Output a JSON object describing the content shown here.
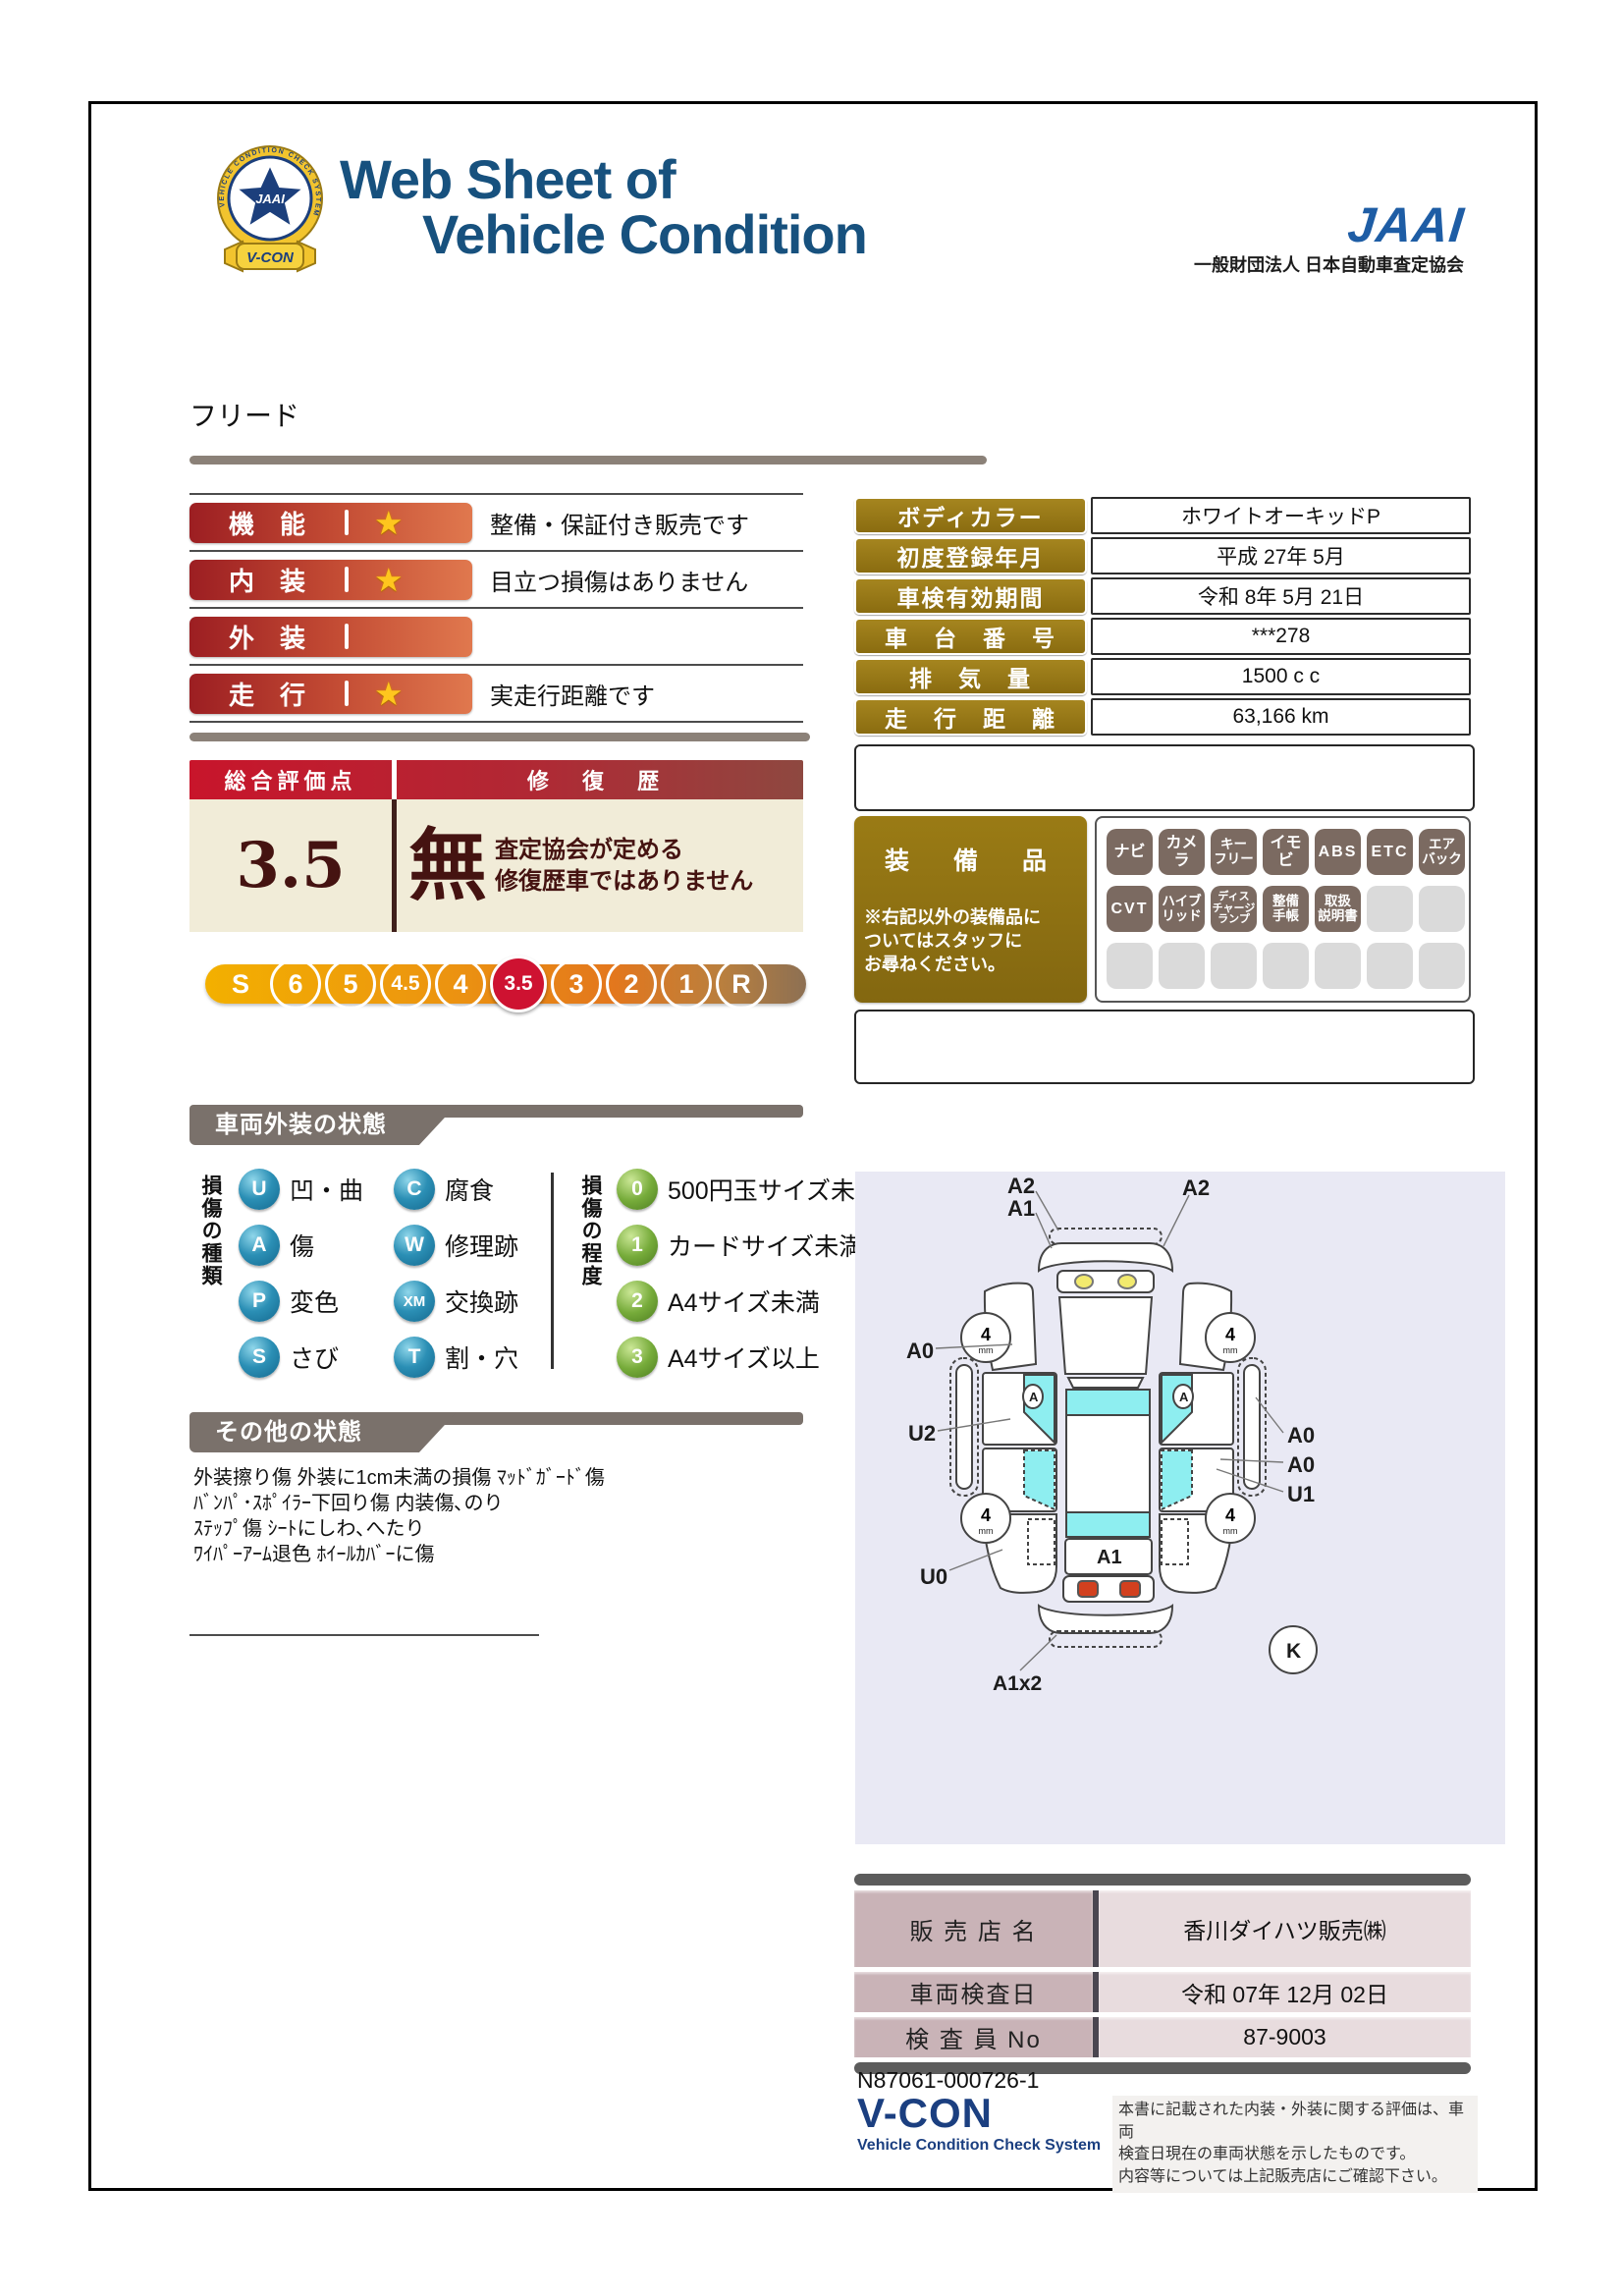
{
  "header": {
    "title_line1": "Web Sheet of",
    "title_line2": "Vehicle Condition",
    "emblem": {
      "ring_text": "VEHICLE CONDITION CHECK SYSTEM",
      "center": "JAAI",
      "ribbon": "V-CON"
    },
    "jaai": {
      "logo": "JAAI",
      "org": "一般財団法人 日本自動車査定協会"
    }
  },
  "vehicle_name": "フリード",
  "ratings": {
    "rows": [
      {
        "label": "機　能",
        "star": true,
        "comment": "整備・保証付き販売です"
      },
      {
        "label": "内　装",
        "star": true,
        "comment": "目立つ損傷はありません"
      },
      {
        "label": "外　装",
        "star": false,
        "comment": ""
      },
      {
        "label": "走　行",
        "star": true,
        "comment": "実走行距離です"
      }
    ]
  },
  "overall": {
    "header_left": "総合評価点",
    "header_right": "修 復 歴",
    "score": "3.5",
    "repair_mark": "無",
    "repair_note": "査定協会が定める\n修復歴車ではありません",
    "scale": [
      {
        "v": "S",
        "ring": false
      },
      {
        "v": "6"
      },
      {
        "v": "5"
      },
      {
        "v": "4.5"
      },
      {
        "v": "4"
      },
      {
        "v": "3.5",
        "active": true
      },
      {
        "v": "3"
      },
      {
        "v": "2"
      },
      {
        "v": "1"
      },
      {
        "v": "R"
      }
    ]
  },
  "info_table": {
    "rows": [
      {
        "label": "ボディカラー",
        "value": "ホワイトオーキッドP"
      },
      {
        "label": "初度登録年月",
        "value": "平成 27年 5月"
      },
      {
        "label": "車検有効期間",
        "value": "令和 8年 5月 21日"
      },
      {
        "label": "車　台　番　号",
        "value": "***278"
      },
      {
        "label": "排　気　量",
        "value": "1500 c c"
      },
      {
        "label": "走　行　距　離",
        "value": "63,166 km"
      }
    ]
  },
  "equipment": {
    "title": "装　備　品",
    "note": "※右記以外の装備品に\nついてはスタッフに\nお尋ねください。",
    "badges": [
      {
        "label": "ナビ",
        "active": true
      },
      {
        "label": "カメラ",
        "active": true
      },
      {
        "label": "キー\nフリー",
        "active": true
      },
      {
        "label": "イモビ",
        "active": true
      },
      {
        "label": "ABS",
        "active": true
      },
      {
        "label": "ETC",
        "active": true
      },
      {
        "label": "エア\nバック",
        "active": true
      },
      {
        "label": "CVT",
        "active": true
      },
      {
        "label": "ハイブ\nリッド",
        "active": true
      },
      {
        "label": "ディス\nチャージ\nランプ",
        "active": true
      },
      {
        "label": "整備\n手帳",
        "active": true
      },
      {
        "label": "取扱\n説明書",
        "active": true
      },
      {
        "label": "",
        "active": false
      },
      {
        "label": "",
        "active": false
      },
      {
        "label": "",
        "active": false
      },
      {
        "label": "",
        "active": false
      },
      {
        "label": "",
        "active": false
      },
      {
        "label": "",
        "active": false
      },
      {
        "label": "",
        "active": false
      },
      {
        "label": "",
        "active": false
      },
      {
        "label": "",
        "active": false
      }
    ]
  },
  "exterior_section": {
    "title": "車両外装の状態",
    "kind_label": "損傷の種類",
    "kinds": [
      {
        "code": "U",
        "label": "凹・曲"
      },
      {
        "code": "C",
        "label": "腐食"
      },
      {
        "code": "A",
        "label": "傷"
      },
      {
        "code": "W",
        "label": "修理跡"
      },
      {
        "code": "P",
        "label": "変色"
      },
      {
        "code": "XM",
        "label": "交換跡"
      },
      {
        "code": "S",
        "label": "さび"
      },
      {
        "code": "T",
        "label": "割・穴"
      }
    ],
    "degree_label": "損傷の程度",
    "degrees": [
      {
        "code": "0",
        "label": "500円玉サイズ未満"
      },
      {
        "code": "1",
        "label": "カードサイズ未満"
      },
      {
        "code": "2",
        "label": "A4サイズ未満"
      },
      {
        "code": "3",
        "label": "A4サイズ以上"
      }
    ]
  },
  "other_section": {
    "title": "その他の状態",
    "lines": "外装擦り傷 外装に1cm未満の損傷 ﾏｯﾄﾞｶﾞｰﾄﾞ傷\nﾊﾞﾝﾊﾟ･ｽﾎﾟｲﾗｰ下回り傷 内装傷､のり\nｽﾃｯﾌﾟ傷 ｼｰﾄにしわ､へたり\nﾜｲﾊﾟｰｱｰﾑ退色 ﾎｲｰﾙｶﾊﾞｰに傷"
  },
  "diagram": {
    "labels": {
      "front_left_top": "A2",
      "front_left_bottom": "A1",
      "front_right": "A2",
      "left_fender": "A0",
      "left_door": "U2",
      "left_rear": "U0",
      "right_sill": "A0",
      "right_door": "A0",
      "right_quarter": "U1",
      "tailgate": "A1",
      "rear_bumper": "A1x2",
      "corner": "K",
      "door_mark": "A",
      "tread_depth": "4",
      "tread_unit": "mm"
    }
  },
  "dealer_table": {
    "rows": [
      {
        "label": "販 売 店 名",
        "value": "香川ダイハツ販売㈱"
      },
      {
        "label": "車両検査日",
        "value": "令和 07年 12月 02日"
      },
      {
        "label": "検 査 員 No",
        "value": "87-9003"
      }
    ]
  },
  "footer": {
    "serial": "N87061-000726-1",
    "vcon": "V-CON",
    "vcon_sub": "Vehicle Condition Check System",
    "disclaimer": "本書に記載された内装・外装に関する評価は、車両\n検査日現在の車両状態を示したものです。\n内容等については上記販売店にご確認下さい。"
  }
}
